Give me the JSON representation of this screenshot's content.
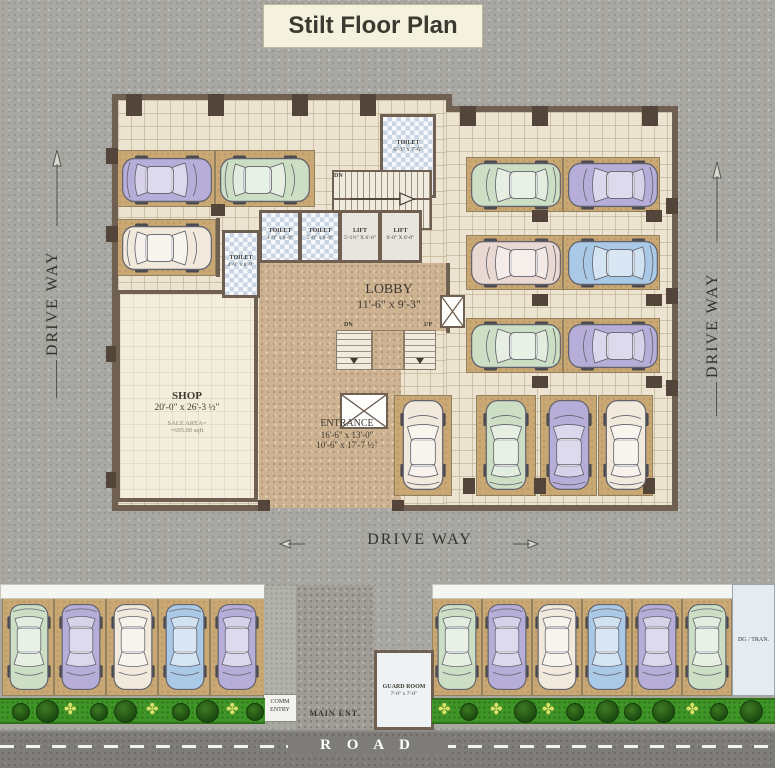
{
  "title": "Stilt Floor Plan",
  "labels": {
    "driveway_left": "DRIVE WAY",
    "driveway_right": "DRIVE WAY",
    "driveway_bottom": "DRIVE WAY",
    "road": "R O A D",
    "dn_upper": "DN",
    "dn_lower": "DN",
    "up_lower": "UP"
  },
  "rooms": {
    "toilet_top": {
      "name": "TOILET",
      "dims": "6'-3\" x 7'-6\""
    },
    "toilet_left": {
      "name": "TOILET",
      "dims": "4'-9\" x 8'-9\""
    },
    "toilet_a": {
      "name": "TOILET",
      "dims": "4'-9\" x 6'-9\""
    },
    "toilet_b": {
      "name": "TOILET",
      "dims": "5'-0\" x 6'-9\""
    },
    "lift_a": {
      "name": "LIFT",
      "dims": "5'-1½\" X 6'-0\""
    },
    "lift_b": {
      "name": "LIFT",
      "dims": "6'-0\" X 6'-0\""
    },
    "lobby": {
      "name": "LOBBY",
      "dims": "11'-6\" x 9'-3\""
    },
    "shop": {
      "name": "SHOP",
      "dims": "20'-0\" x 26'-3 ½\"",
      "sale1": "SALE AREA=",
      "sale2": "=695.00 sqft"
    },
    "entrance": {
      "name": "ENTRANCE",
      "d1": "16'-6\" x 13'-0\"",
      "d2": "10'-6\" x 17'-7 ½\""
    },
    "guard": {
      "name": "GUARD ROOM",
      "dims": "7'-0\" x 7'-0\""
    },
    "dg": {
      "name": "DG / TRAN."
    },
    "comm": {
      "line1": "COMM",
      "line2": "ENTRY"
    },
    "main_ent": "MAIN ENT."
  },
  "colors": {
    "wall": "#6f6052",
    "column": "#54453a",
    "stall": "#c9a873",
    "floor": "#ece4d1",
    "tan": "#cdb392",
    "hedge": "#3f9527",
    "road": "#7d7c78",
    "title_bg": "#f4f1de",
    "car": {
      "purple": "#b6aed8",
      "green": "#ccdfc5",
      "cream": "#f0e9dc",
      "blue": "#aac9e6",
      "pink": "#ead9d2"
    }
  },
  "geometry": {
    "walls": [
      [
        112,
        94,
        340,
        6
      ],
      [
        446,
        100,
        6,
        12
      ],
      [
        446,
        106,
        232,
        6
      ],
      [
        672,
        112,
        6,
        399
      ],
      [
        112,
        100,
        6,
        411
      ],
      [
        112,
        505,
        152,
        6
      ],
      [
        396,
        505,
        282,
        6
      ],
      [
        446,
        263,
        4,
        70
      ],
      [
        256,
        263,
        4,
        29
      ],
      [
        216,
        218,
        4,
        59
      ]
    ],
    "columns": [
      [
        126,
        94,
        16,
        22
      ],
      [
        208,
        94,
        16,
        22
      ],
      [
        292,
        94,
        16,
        22
      ],
      [
        360,
        94,
        16,
        22
      ],
      [
        460,
        106,
        16,
        20
      ],
      [
        532,
        106,
        16,
        20
      ],
      [
        642,
        106,
        16,
        20
      ],
      [
        666,
        198,
        12,
        16
      ],
      [
        666,
        288,
        12,
        16
      ],
      [
        666,
        380,
        12,
        16
      ],
      [
        106,
        148,
        12,
        16
      ],
      [
        106,
        226,
        12,
        16
      ],
      [
        106,
        346,
        12,
        16
      ],
      [
        106,
        472,
        12,
        16
      ],
      [
        532,
        210,
        16,
        12
      ],
      [
        646,
        210,
        16,
        12
      ],
      [
        532,
        294,
        16,
        12
      ],
      [
        646,
        294,
        16,
        12
      ],
      [
        532,
        376,
        16,
        12
      ],
      [
        646,
        376,
        16,
        12
      ],
      [
        463,
        478,
        12,
        16
      ],
      [
        534,
        478,
        12,
        16
      ],
      [
        643,
        478,
        12,
        16
      ],
      [
        211,
        204,
        14,
        12
      ],
      [
        258,
        500,
        12,
        11
      ],
      [
        392,
        500,
        12,
        11
      ]
    ],
    "stalls": [
      [
        116,
        150,
        99,
        57
      ],
      [
        215,
        150,
        100,
        57
      ],
      [
        116,
        219,
        100,
        57
      ],
      [
        466,
        157,
        97,
        55
      ],
      [
        563,
        157,
        97,
        55
      ],
      [
        466,
        235,
        97,
        55
      ],
      [
        563,
        235,
        97,
        55
      ],
      [
        466,
        318,
        97,
        55
      ],
      [
        563,
        318,
        97,
        55
      ],
      [
        394,
        395,
        58,
        101
      ],
      [
        476,
        395,
        60,
        101
      ],
      [
        540,
        395,
        57,
        101
      ],
      [
        598,
        395,
        55,
        101
      ],
      [
        2,
        598,
        52,
        98
      ],
      [
        54,
        598,
        52,
        98
      ],
      [
        106,
        598,
        52,
        98
      ],
      [
        158,
        598,
        52,
        98
      ],
      [
        210,
        598,
        55,
        98
      ],
      [
        432,
        598,
        50,
        98
      ],
      [
        482,
        598,
        50,
        98
      ],
      [
        532,
        598,
        50,
        98
      ],
      [
        582,
        598,
        50,
        98
      ],
      [
        632,
        598,
        50,
        98
      ],
      [
        682,
        598,
        50,
        98
      ]
    ],
    "cars": [
      {
        "x": 121,
        "y": 155,
        "w": 92,
        "h": 50,
        "dir": "right",
        "color": "purple"
      },
      {
        "x": 219,
        "y": 155,
        "w": 92,
        "h": 50,
        "dir": "right",
        "color": "green"
      },
      {
        "x": 121,
        "y": 223,
        "w": 92,
        "h": 50,
        "dir": "right",
        "color": "cream"
      },
      {
        "x": 470,
        "y": 160,
        "w": 92,
        "h": 50,
        "dir": "left",
        "color": "green"
      },
      {
        "x": 567,
        "y": 160,
        "w": 92,
        "h": 50,
        "dir": "left",
        "color": "purple"
      },
      {
        "x": 470,
        "y": 238,
        "w": 92,
        "h": 50,
        "dir": "left",
        "color": "pink"
      },
      {
        "x": 567,
        "y": 238,
        "w": 92,
        "h": 50,
        "dir": "left",
        "color": "blue"
      },
      {
        "x": 470,
        "y": 321,
        "w": 92,
        "h": 50,
        "dir": "left",
        "color": "green"
      },
      {
        "x": 567,
        "y": 321,
        "w": 92,
        "h": 50,
        "dir": "left",
        "color": "purple"
      },
      {
        "x": 400,
        "y": 399,
        "w": 46,
        "h": 92,
        "dir": "up",
        "color": "cream"
      },
      {
        "x": 483,
        "y": 399,
        "w": 46,
        "h": 92,
        "dir": "up",
        "color": "green"
      },
      {
        "x": 546,
        "y": 399,
        "w": 46,
        "h": 92,
        "dir": "up",
        "color": "purple"
      },
      {
        "x": 603,
        "y": 399,
        "w": 46,
        "h": 92,
        "dir": "up",
        "color": "cream"
      },
      {
        "x": 7,
        "y": 603,
        "w": 44,
        "h": 88,
        "dir": "down",
        "color": "green"
      },
      {
        "x": 59,
        "y": 603,
        "w": 44,
        "h": 88,
        "dir": "down",
        "color": "purple"
      },
      {
        "x": 111,
        "y": 603,
        "w": 44,
        "h": 88,
        "dir": "down",
        "color": "cream"
      },
      {
        "x": 163,
        "y": 603,
        "w": 44,
        "h": 88,
        "dir": "down",
        "color": "blue"
      },
      {
        "x": 215,
        "y": 603,
        "w": 44,
        "h": 88,
        "dir": "down",
        "color": "purple"
      },
      {
        "x": 435,
        "y": 603,
        "w": 44,
        "h": 88,
        "dir": "down",
        "color": "green"
      },
      {
        "x": 485,
        "y": 603,
        "w": 44,
        "h": 88,
        "dir": "down",
        "color": "purple"
      },
      {
        "x": 535,
        "y": 603,
        "w": 44,
        "h": 88,
        "dir": "down",
        "color": "cream"
      },
      {
        "x": 585,
        "y": 603,
        "w": 44,
        "h": 88,
        "dir": "down",
        "color": "blue"
      },
      {
        "x": 635,
        "y": 603,
        "w": 44,
        "h": 88,
        "dir": "down",
        "color": "purple"
      },
      {
        "x": 685,
        "y": 603,
        "w": 44,
        "h": 88,
        "dir": "down",
        "color": "green"
      }
    ],
    "hedges": [
      {
        "x": 0,
        "y": 698,
        "w": 265,
        "h": 26,
        "plants": [
          {
            "x": 12,
            "t": "b"
          },
          {
            "x": 36,
            "t": "B"
          },
          {
            "x": 64,
            "t": "f"
          },
          {
            "x": 90,
            "t": "b"
          },
          {
            "x": 114,
            "t": "B"
          },
          {
            "x": 146,
            "t": "f"
          },
          {
            "x": 172,
            "t": "b"
          },
          {
            "x": 196,
            "t": "B"
          },
          {
            "x": 226,
            "t": "f"
          },
          {
            "x": 246,
            "t": "b"
          }
        ]
      },
      {
        "x": 432,
        "y": 698,
        "w": 343,
        "h": 26,
        "plants": [
          {
            "x": 438,
            "t": "f"
          },
          {
            "x": 460,
            "t": "b"
          },
          {
            "x": 490,
            "t": "f"
          },
          {
            "x": 514,
            "t": "B"
          },
          {
            "x": 542,
            "t": "f"
          },
          {
            "x": 566,
            "t": "b"
          },
          {
            "x": 596,
            "t": "B"
          },
          {
            "x": 624,
            "t": "b"
          },
          {
            "x": 652,
            "t": "B"
          },
          {
            "x": 686,
            "t": "f"
          },
          {
            "x": 710,
            "t": "b"
          },
          {
            "x": 740,
            "t": "B"
          }
        ]
      }
    ]
  }
}
